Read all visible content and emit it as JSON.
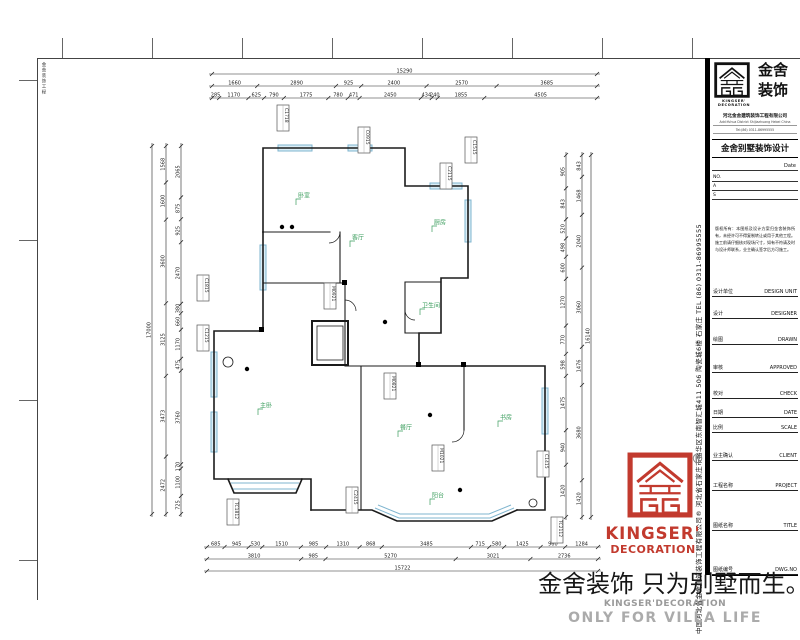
{
  "frame": {
    "side_note": "金舍装饰工程"
  },
  "titleblock": {
    "logo_cn_1": "金舍",
    "logo_cn_2": "装饰",
    "brand_line1": "KINGSER'",
    "brand_line2": "DECORATION",
    "company_line": "河北金舍建筑装饰工程有限公司",
    "addr_line1": "Add:Yuhua District Shijiazhuang Hebei China",
    "addr_line2": "Tel:(86) 0311-86995555",
    "doc_title": "金舍别墅装饰设计",
    "date_label": "Date",
    "no_label": "NO.",
    "a_label": "A",
    "s_label": "S",
    "notes": "版权所有：本图纸及设计方案归金舍装饰所有，未经许可不得复制转让或用于其他工程。施工前请仔细核对现场尺寸，如有不符请及时与设计师联系，业主确认签字后方可施工。",
    "rows": [
      {
        "cn": "设计单位",
        "en": "DESIGN UNIT"
      },
      {
        "cn": "设计",
        "en": "DESIGNER"
      },
      {
        "cn": "绘图",
        "en": "DRAWN"
      },
      {
        "cn": "审核",
        "en": "APPROVED"
      },
      {
        "cn": "校对",
        "en": "CHECK"
      },
      {
        "cn": "日期",
        "en": "DATE"
      },
      {
        "cn": "比例",
        "en": "SCALE"
      },
      {
        "cn": "业主确认",
        "en": "CLIENT"
      },
      {
        "cn": "工程名称",
        "en": "PROJECT"
      },
      {
        "cn": "图纸名称",
        "en": "TITLE"
      },
      {
        "cn": "图纸编号",
        "en": "DWG.NO"
      }
    ],
    "side_text": "中国河北省金舍建筑装饰工程有限公司®  河北省石家庄市裕华区东南智汇城411 506 陶瓷城6楼  石家庄 TEL (86) 0311-86995555"
  },
  "stamp": {
    "reg": "®",
    "line1": "KINGSER'",
    "line2": "DECORATION",
    "color": "#c23a2e"
  },
  "footer": {
    "slogan": "金舍装饰 只为别墅而生。",
    "sub1": "KINGSER'DECORATION",
    "sub2": "ONLY FOR VILLA LIFE"
  },
  "plan": {
    "colors": {
      "wall": "#1b1b1b",
      "window": "#7fb5cf",
      "window_fill": "#dbeef7",
      "label": "#3a9d5c",
      "dim": "#222222"
    },
    "dims": [
      {
        "o": "h",
        "pos": 74,
        "a": 212,
        "b": 597,
        "vals": [
          "15290"
        ]
      },
      {
        "o": "h",
        "pos": 86,
        "a": 212,
        "b": 597,
        "vals": [
          "1660",
          "2890",
          "925",
          "2400",
          "2570",
          "3685"
        ]
      },
      {
        "o": "h",
        "pos": 98,
        "a": 212,
        "b": 597,
        "vals": [
          "285",
          "1170",
          "625",
          "790",
          "1775",
          "780",
          "471",
          "2450",
          "434",
          "240",
          "1855",
          "4505"
        ]
      },
      {
        "o": "h",
        "pos": 547,
        "a": 207,
        "b": 598,
        "vals": [
          "685",
          "945",
          "530",
          "1510",
          "985",
          "1310",
          "868",
          "3485",
          "715",
          "580",
          "1425",
          "960",
          "1284"
        ]
      },
      {
        "o": "h",
        "pos": 559,
        "a": 207,
        "b": 598,
        "vals": [
          "3810",
          "985",
          "5270",
          "3021",
          "2736"
        ]
      },
      {
        "o": "h",
        "pos": 571,
        "a": 207,
        "b": 598,
        "vals": [
          "15722"
        ]
      },
      {
        "o": "v",
        "pos": 152,
        "a": 146,
        "b": 514,
        "vals": [
          "17000"
        ]
      },
      {
        "o": "v",
        "pos": 166,
        "a": 146,
        "b": 514,
        "vals": [
          "1568",
          "1600",
          "3600",
          "3125",
          "3473",
          "2472"
        ]
      },
      {
        "o": "v",
        "pos": 181,
        "a": 146,
        "b": 514,
        "vals": [
          "2065",
          "875",
          "925",
          "2470",
          "380",
          "660",
          "1170",
          "475",
          "3760",
          "170",
          "1100",
          "725"
        ]
      },
      {
        "o": "v",
        "pos": 566,
        "a": 155,
        "b": 517,
        "vals": [
          "905",
          "843",
          "520",
          "498",
          "600",
          "1270",
          "770",
          "598",
          "1475",
          "940",
          "1420"
        ]
      },
      {
        "o": "v",
        "pos": 582,
        "a": 155,
        "b": 517,
        "vals": [
          "843",
          "1468",
          "2040",
          "3060",
          "1476",
          "3680",
          "1420"
        ]
      },
      {
        "o": "v",
        "pos": 591,
        "a": 155,
        "b": 517,
        "vals": [
          "16140"
        ]
      }
    ],
    "tags": [
      {
        "x": 283,
        "y": 118,
        "t": "C1718"
      },
      {
        "x": 364,
        "y": 140,
        "t": "C0915"
      },
      {
        "x": 446,
        "y": 176,
        "t": "C2115"
      },
      {
        "x": 471,
        "y": 150,
        "t": "C1515"
      },
      {
        "x": 203,
        "y": 288,
        "t": "C1815"
      },
      {
        "x": 203,
        "y": 338,
        "t": "C1215"
      },
      {
        "x": 330,
        "y": 296,
        "t": "M0921"
      },
      {
        "x": 390,
        "y": 386,
        "t": "M0821"
      },
      {
        "x": 233,
        "y": 512,
        "t": "TC1812"
      },
      {
        "x": 352,
        "y": 500,
        "t": "C2415"
      },
      {
        "x": 438,
        "y": 458,
        "t": "M1021"
      },
      {
        "x": 543,
        "y": 464,
        "t": "C1415"
      },
      {
        "x": 557,
        "y": 530,
        "t": "TC2112"
      }
    ],
    "room_labels": [
      {
        "x": 296,
        "y": 198,
        "t": "卧室"
      },
      {
        "x": 350,
        "y": 240,
        "t": "客厅"
      },
      {
        "x": 432,
        "y": 225,
        "t": "厨房"
      },
      {
        "x": 420,
        "y": 308,
        "t": "卫生间"
      },
      {
        "x": 258,
        "y": 408,
        "t": "主卧"
      },
      {
        "x": 398,
        "y": 430,
        "t": "餐厅"
      },
      {
        "x": 498,
        "y": 420,
        "t": "书房"
      },
      {
        "x": 430,
        "y": 498,
        "t": "阳台"
      }
    ]
  }
}
